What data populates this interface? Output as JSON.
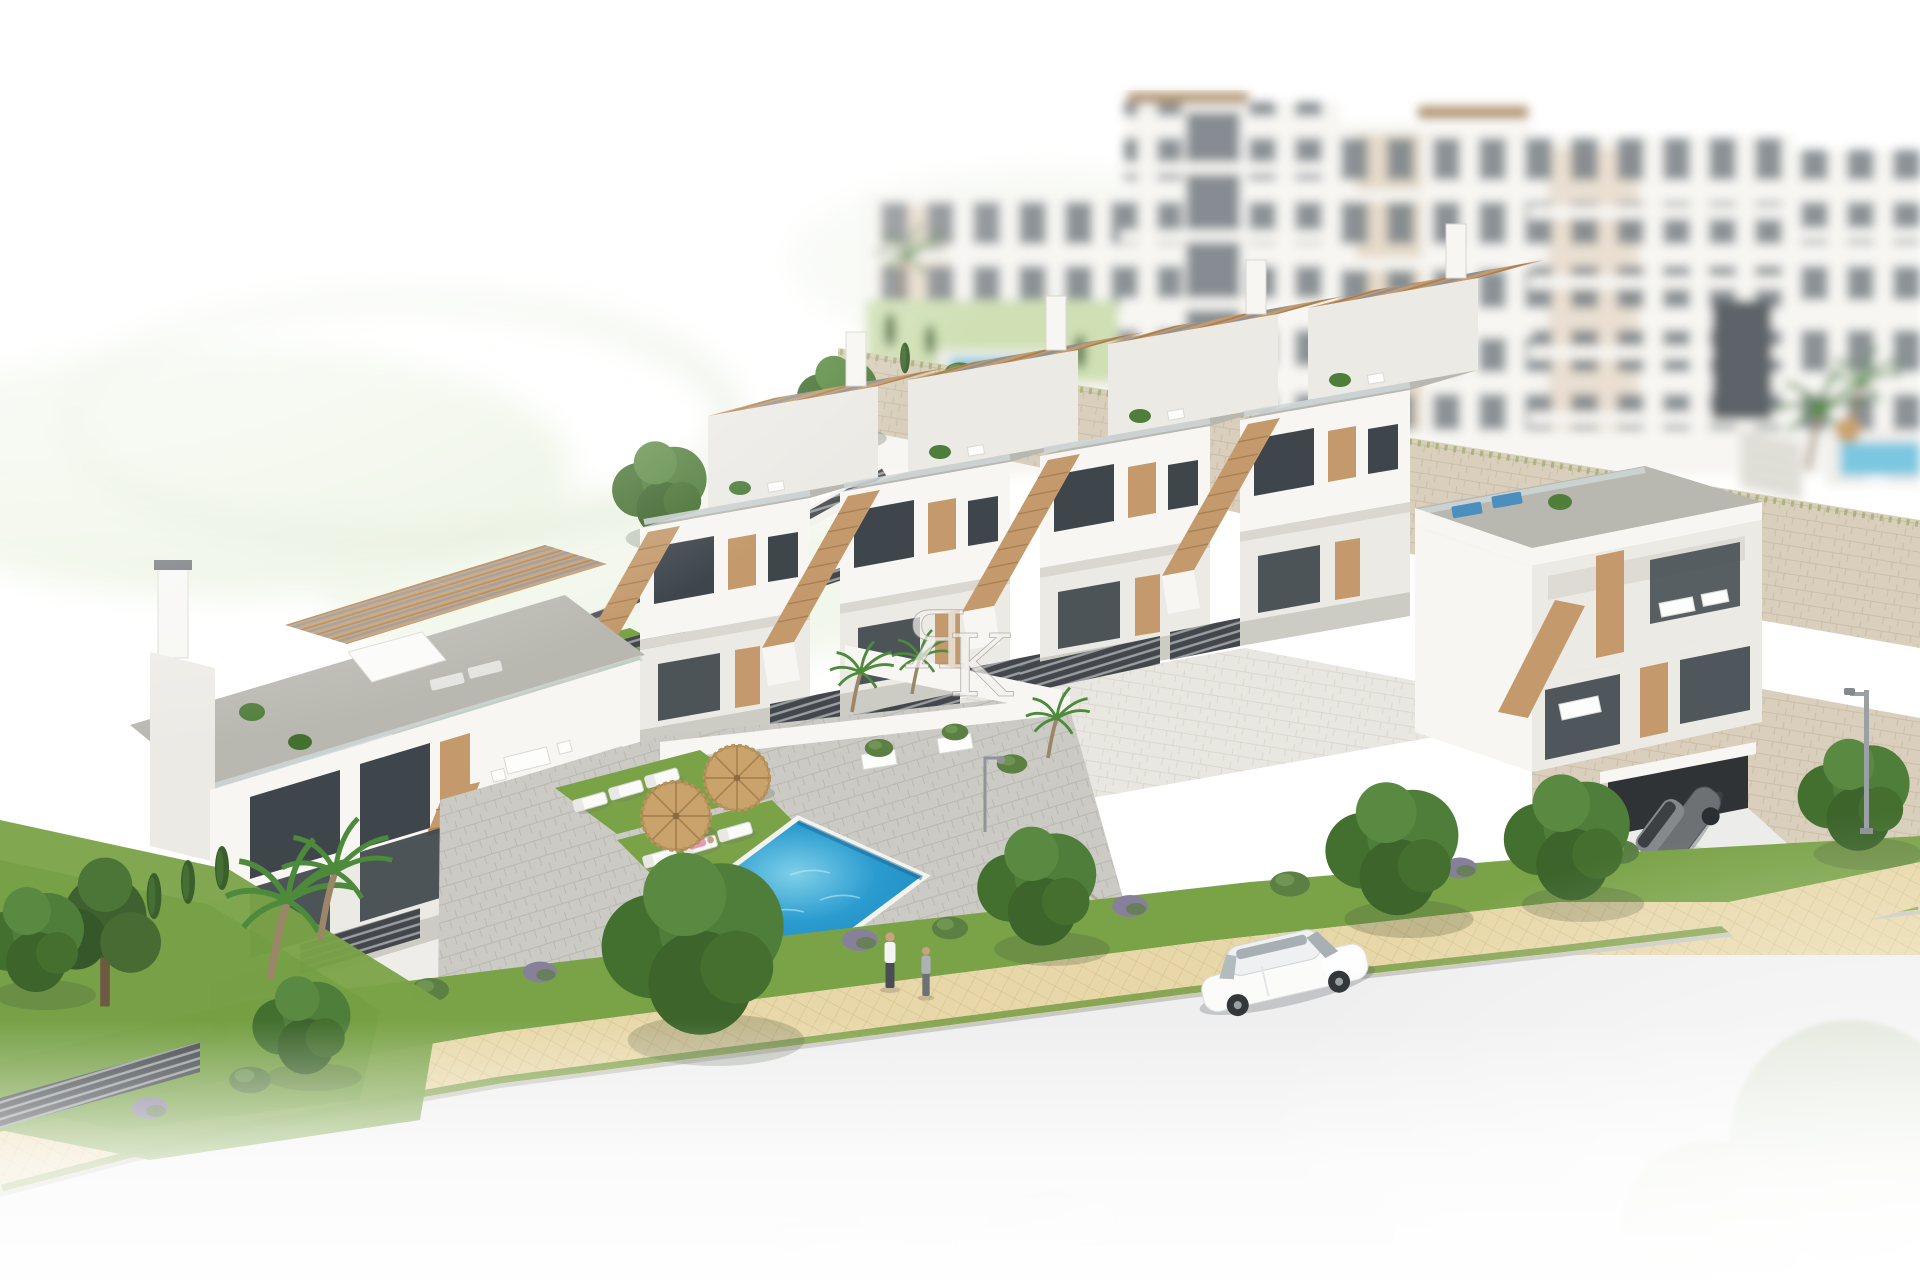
{
  "watermark": {
    "text": "ЯK",
    "letters": {
      "ya": "Я",
      "k": "K"
    }
  },
  "palette": {
    "background": "#ffffff",
    "hill_green": "#e9f1dd",
    "building_white": "#f7f6f3",
    "building_shade": "#eceae5",
    "building_shade_dark": "#d9d7d0",
    "roof_deck": "#b8b7b0",
    "roof_deck_light": "#cccbc4",
    "window_glass": "#3e464c",
    "window_glass_light": "#6b747b",
    "wood": "#c49a6c",
    "wood_dark": "#a87f52",
    "stone_wall": "#d9cfbc",
    "stone_joint": "#c2b69d",
    "slat_fence": "#43474b",
    "pool_deep": "#1b85bb",
    "pool_mid": "#2b9cd0",
    "pool_light": "#7fd0e8",
    "lawn": "#7aa348",
    "lawn_dark": "#5c8a33",
    "tree_green": "#4f7d3a",
    "tree_dark": "#35582a",
    "cypress": "#3a5f2d",
    "path_sand": "#e8d8a9",
    "path_sand_dark": "#d6c28e",
    "road": "#efeff0",
    "car_white": "#fbfbfa",
    "car_grey": "#6e7173",
    "metal_grey": "#9aa0a3",
    "skin": "#caa183",
    "watermark": "#f4f2ee"
  },
  "scene": {
    "kind": "aerial architectural render",
    "background_label": "out-of-focus white apartment blocks on the hilltop",
    "midground_label": "row of white townhouses with roof terraces and tan stairs",
    "foreground_label": "communal pool garden, promenade and street",
    "objects": {
      "apartment_blocks": 5,
      "townhouse_units": 4,
      "corner_house_with_garage": 1,
      "left_duplex_villa": 1,
      "swimming_pool": 1,
      "thatch_umbrellas": 2,
      "sun_loungers": 6,
      "people_walking": 2,
      "person_sunbathing": 1,
      "person_in_pool": 1,
      "white_sedan": 1,
      "grey_coupe": 1,
      "faded_cars": 3,
      "street_lamp": 1
    }
  }
}
